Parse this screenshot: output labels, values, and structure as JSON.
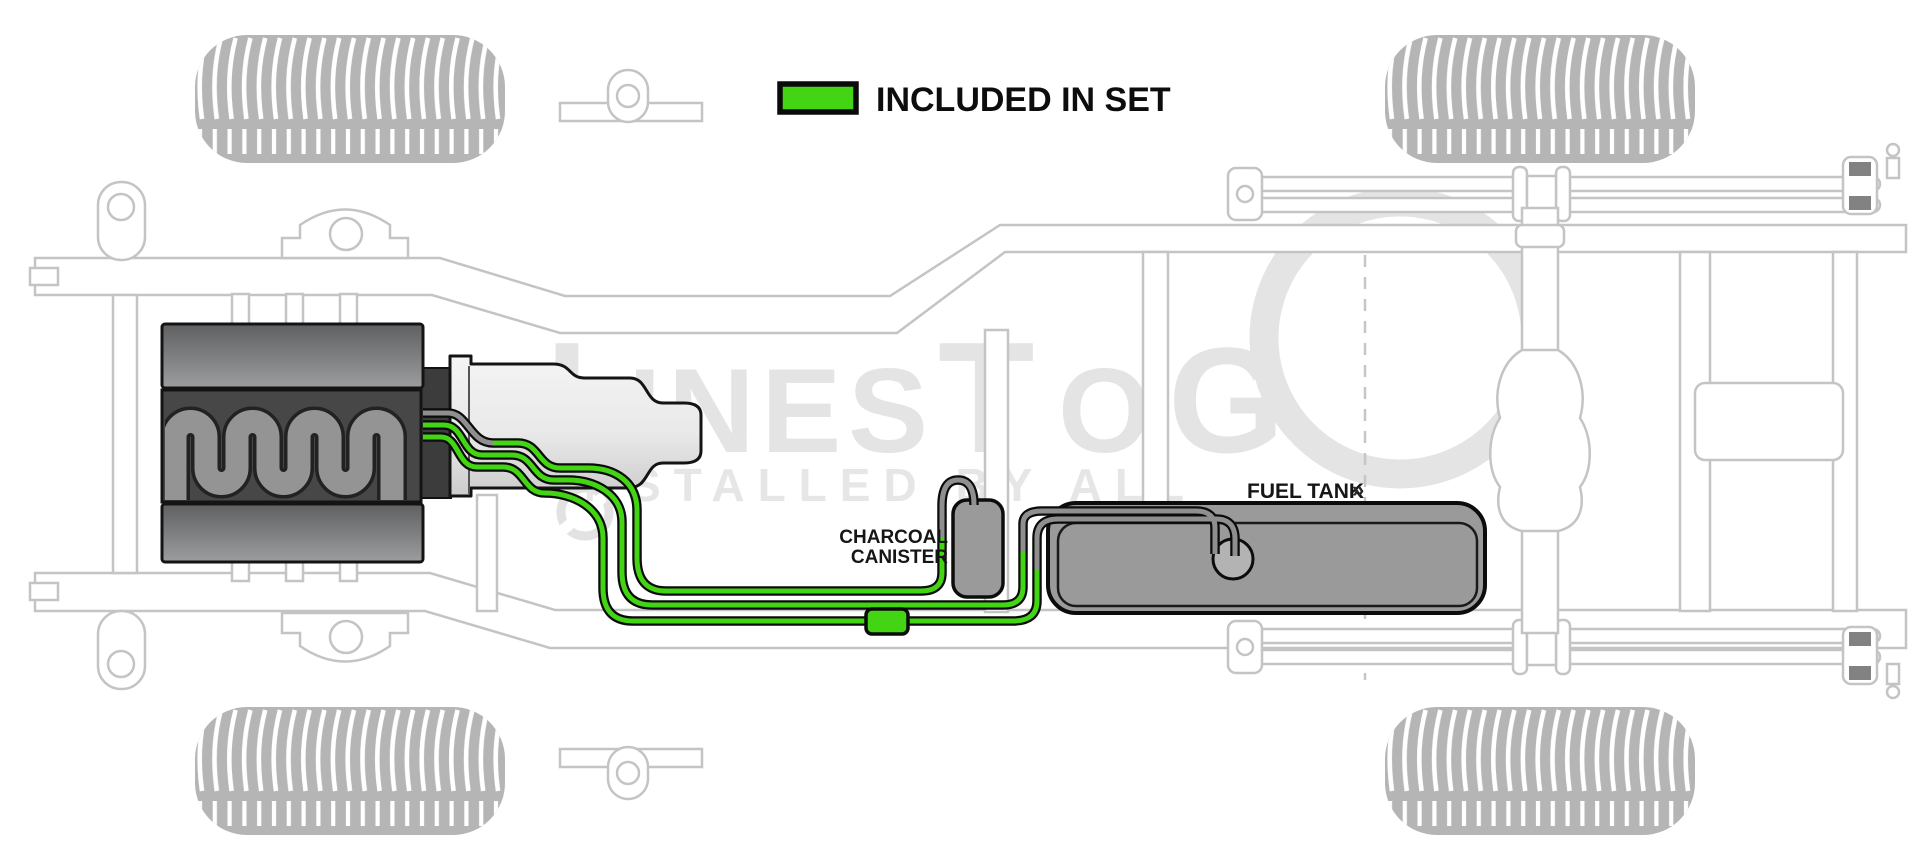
{
  "legend": {
    "label": "INCLUDED IN SET",
    "swatch_color": "#43d513"
  },
  "labels": {
    "charcoal_canister_line1": "CHARCOAL",
    "charcoal_canister_line2": "CANISTER",
    "fuel_tank": "FUEL TANK",
    "fuel_tank_marker": "»"
  },
  "watermark": {
    "part1": "L",
    "part2": "INES",
    "part3": "T",
    "part4": "O",
    "part5": "G",
    "last_letter_shape": "O-ring",
    "line2": "INSTALLED BY ALL"
  },
  "colors": {
    "line_green": "#43d513",
    "line_gray": "#8f8f8f",
    "component_gray": "#9a9a9a",
    "engine_dark": "#474747",
    "frame_gray": "#c4c4c4",
    "watermark_gray": "#e4e4e4",
    "tire_gray": "#b5b5b5"
  }
}
